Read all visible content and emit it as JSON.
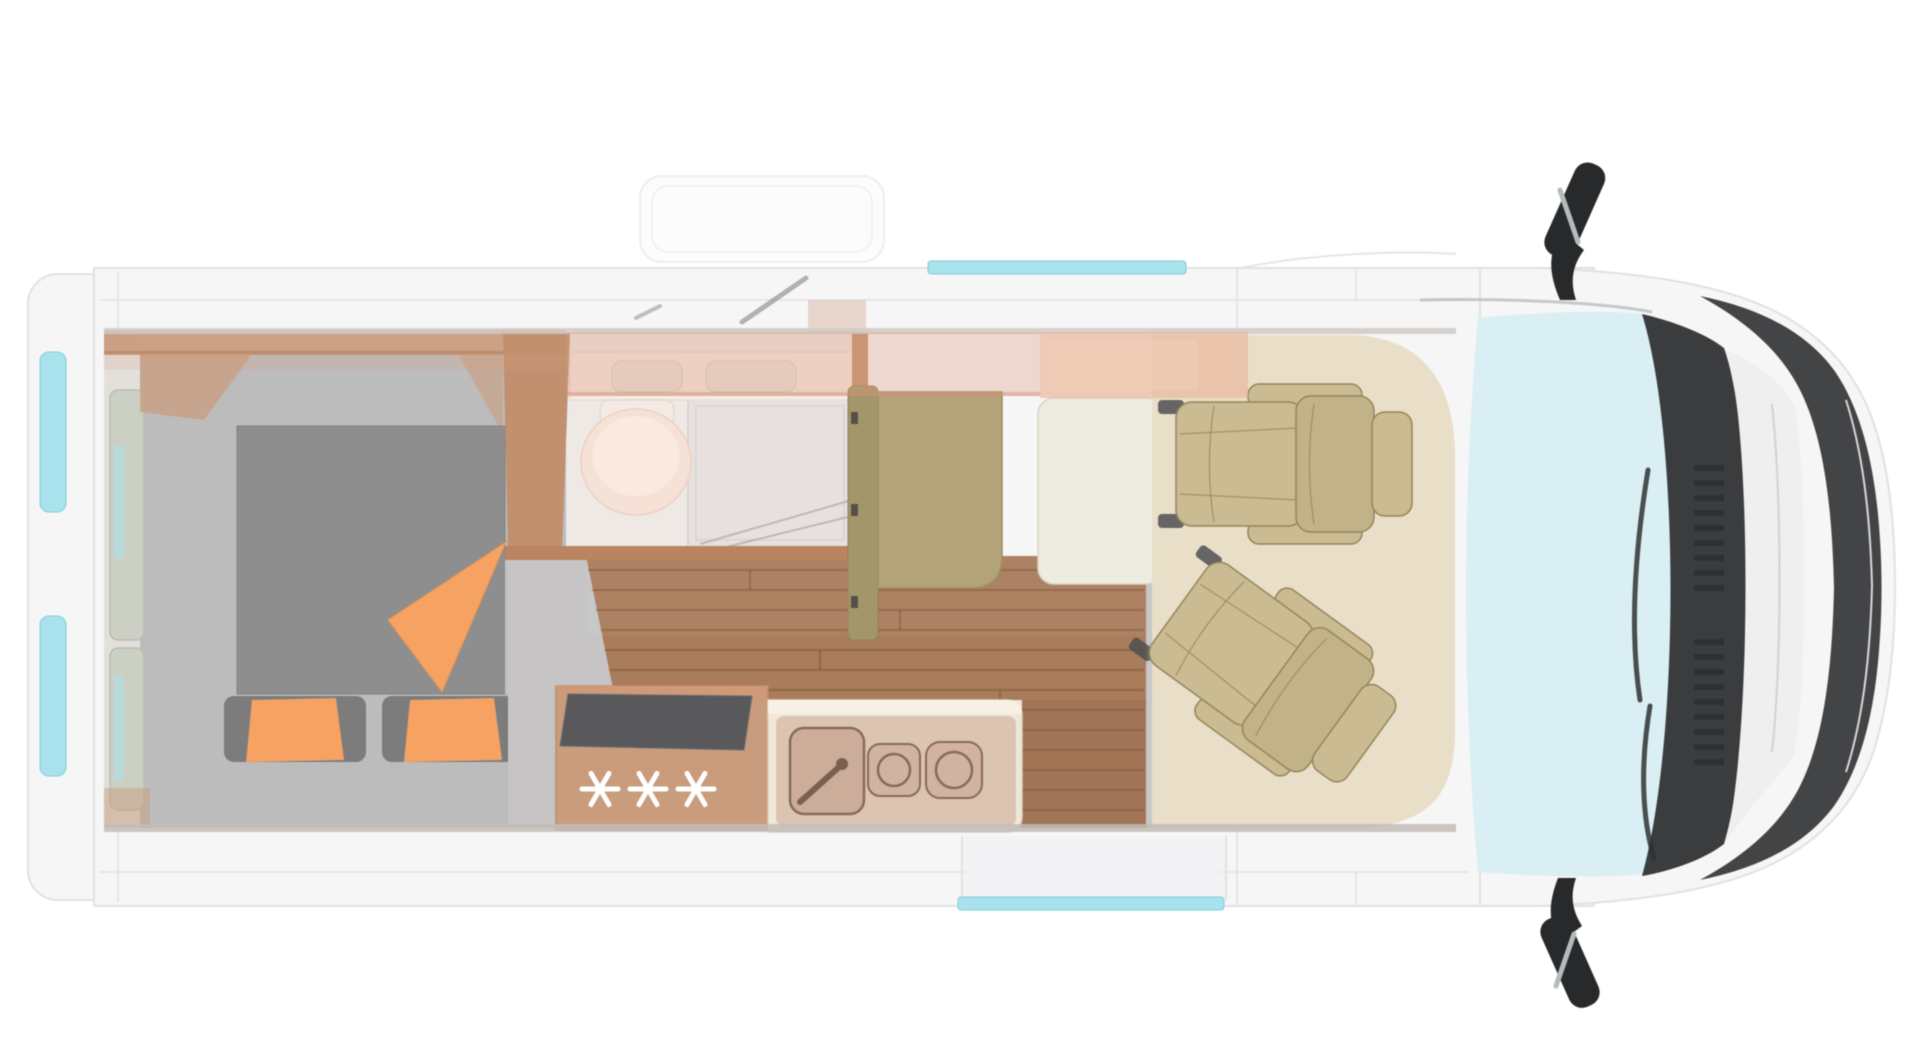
{
  "title": "Camper van floor plan — top view",
  "labels": {
    "fridge_symbols": "✳✳✳"
  },
  "floorplan": {
    "view": "top-down",
    "vehicle_orientation": "cab-at-right",
    "zones": [
      "rear-bed",
      "bathroom",
      "kitchen",
      "dinette",
      "cab"
    ],
    "furniture": [
      "double-bed-with-orange-cushions",
      "bathroom-with-toilet-vanity-shower",
      "wardrobe-partition",
      "two-burner-hob-and-sink",
      "fridge-with-three-snowflake-symbols",
      "dinette-bench-and-table",
      "two-swivel-cab-seats",
      "side-mirrors",
      "windshield"
    ],
    "windows": [
      "top-sliding-window",
      "bottom-sliding-door-window",
      "rear-door-window-upper",
      "rear-door-window-lower"
    ]
  },
  "colors": {
    "page_bg": "#ffffff",
    "body": "#f6f6f7",
    "body_edge": "#e1e1e3",
    "window_glass": "#a7e2ed",
    "window_edge": "#85ccd9",
    "windshield": "#d9eff3",
    "dark_trim": "#3a3c3e",
    "trim_darker": "#27292b",
    "hood": "#efeff0",
    "wood": "#c99c7e",
    "wood_dark": "#b9845f",
    "wood_wall": "#c0906f",
    "floor_wood": "#a97c5b",
    "bedroom_floor": "#bdbcbc",
    "step_floor": "#c6c4c4",
    "bed": "#8e8e8e",
    "pillow": "#7c7c7c",
    "accent_orange": "#f5a263",
    "bath_base": "#efe9e6",
    "vanity": "#f7ece6",
    "toilet": "#f6e1d7",
    "shower": "#e6e0df",
    "bench": "#b2a478",
    "bench_back": "#a2966a",
    "table": "#eeebe1",
    "cab_mat": "#e9dfc8",
    "seat": "#cbbb92",
    "seat_back": "#c2b287",
    "seat_line": "#95855c",
    "overhead": "#dd9f82",
    "overhead_strong": "#e9b89e",
    "fridge_top": "#59595b",
    "cream": "#efe8d9",
    "appliance": "#c9a08b",
    "appliance_line": "#8a6a58"
  }
}
